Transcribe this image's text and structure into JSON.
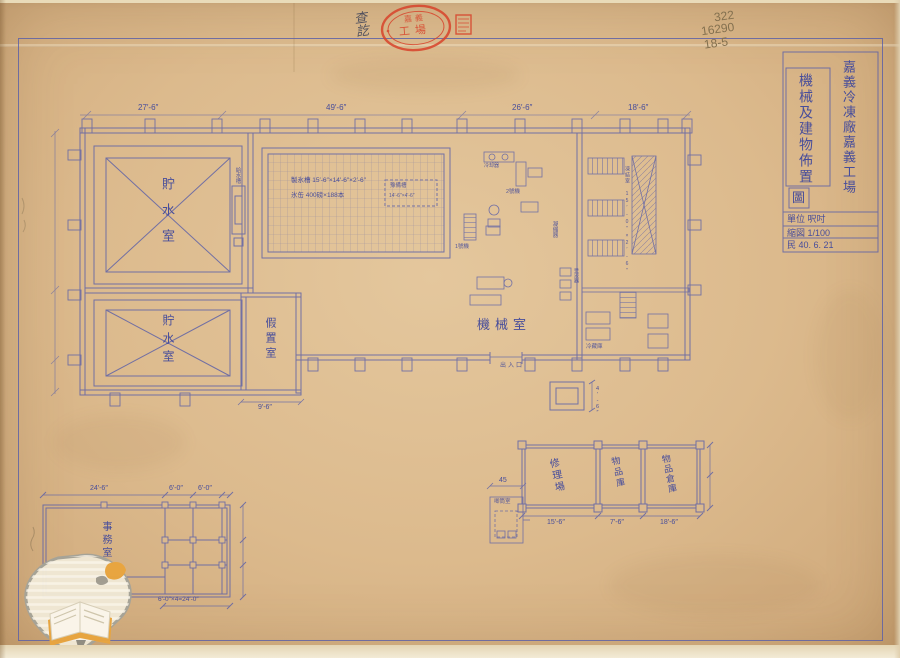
{
  "colors": {
    "paper": "#d9b488",
    "ink": "#5a5fa8",
    "label_text": "#474d9b",
    "pencil": "#83704f",
    "stamp_red": "#d8432b",
    "watermark_orange": "#e9a53e"
  },
  "notes": {
    "pencil": [
      "322",
      "16290",
      "18-5"
    ],
    "ink": "查訖"
  },
  "stamp": {
    "line1": "嘉義",
    "line2": "工場"
  },
  "title_block": {
    "company": "嘉義冷凍廠嘉義工場",
    "title": "機械及建物佈置",
    "boxed": "圖",
    "unit_row": "單位 呎吋",
    "scale_row": "縮図 1/100",
    "date_row": "民 40. 6. 21"
  },
  "rooms": {
    "water_top": "貯水室",
    "water_bottom": "貯水室",
    "temp_room": "假置室",
    "machine_room": "機械室",
    "office": "事務室",
    "repair": "修理場",
    "store_mid": "物品庫",
    "store_right": "物品倉庫",
    "annex": "唧筒室",
    "feed_tank": "給水槽",
    "condenser": "凝縮器",
    "receiver": "受液器",
    "unit_no2": "2號機",
    "unit_no1": "1號機",
    "cooler": "冷却器",
    "entrance": "出入口",
    "freezer_rack": "凍結室 15′-0″×2′-6″",
    "cold_store": "冷藏庫"
  },
  "ice_tank": {
    "line1": "製氷槽 15′-6″×14′-6″×2′-6″",
    "line2": "氷缶 400磅×188本",
    "spare1": "豫備槽",
    "spare2": "14′-6″×4′-6″"
  },
  "dims": {
    "top": [
      "27′-6″",
      "49′-6″",
      "26′-6″",
      "18′-6″"
    ],
    "temp_room": "9′-6″",
    "pad": "4′-6″",
    "annex": "45",
    "storage": [
      "15′-6″",
      "7′-6″",
      "18′-6″"
    ],
    "office_top": [
      "24′-6″",
      "6′-0″",
      "6′-0″"
    ],
    "office_bottom": "6′-0″×4=24′-0″"
  }
}
